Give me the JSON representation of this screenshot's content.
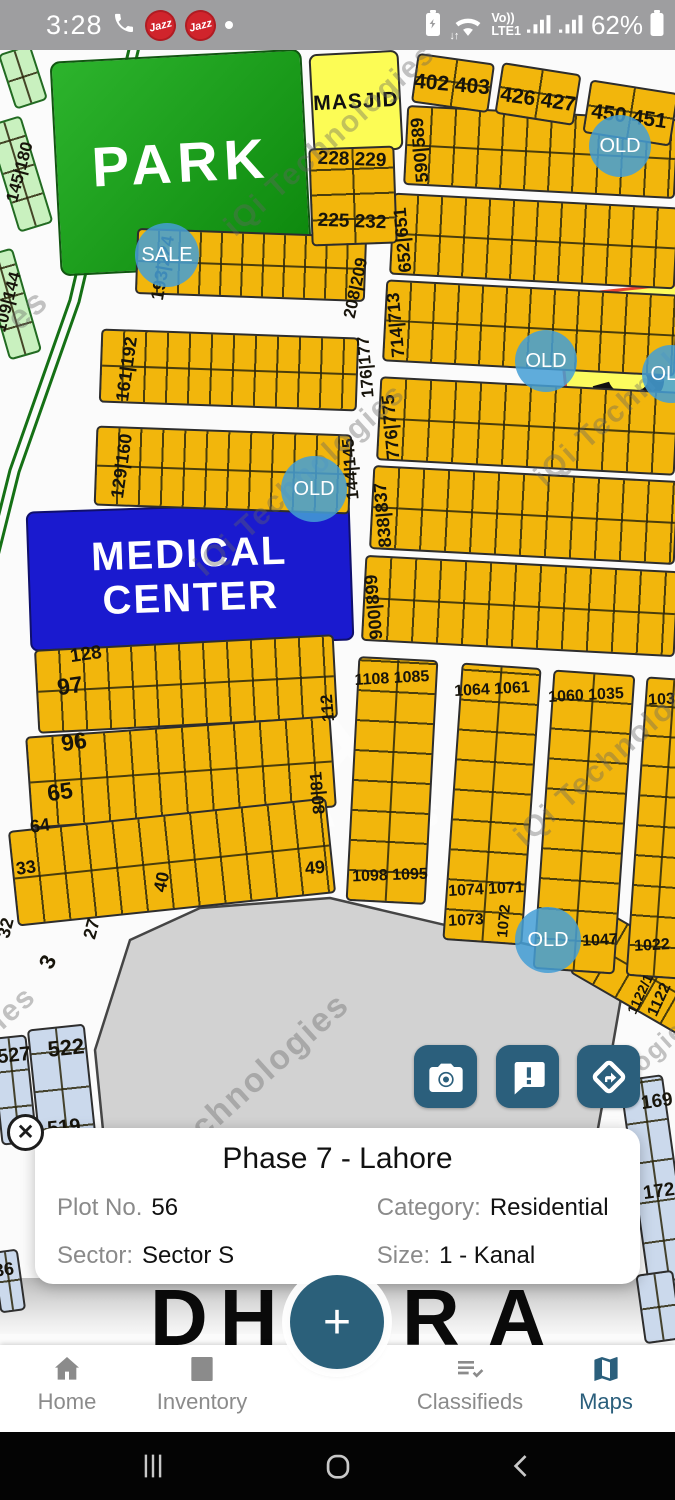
{
  "status_bar": {
    "time": "3:28",
    "carrier_badges": [
      "Jazz",
      "Jazz"
    ],
    "volte_top": "Vo))",
    "volte_bottom": "LTE1",
    "battery_percent": "62%"
  },
  "map": {
    "areas": [
      {
        "id": "park",
        "x": 55,
        "y": 55,
        "w": 252,
        "h": 215,
        "rot": -3,
        "fill": "linear-gradient(135deg,#2db42d,#0c870c)",
        "border": "2.5px solid #115511",
        "radius": 10,
        "title": "PARK",
        "ts": 56,
        "tc": "#ffffff",
        "ls": 6
      },
      {
        "id": "masjid",
        "x": 311,
        "y": 52,
        "w": 90,
        "h": 100,
        "rot": -3,
        "fill": "#fcfc55",
        "border": "2.5px solid #2d2d2d",
        "radius": 8,
        "title": "MASJID",
        "ts": 21,
        "tc": "#111111",
        "ls": 1
      },
      {
        "id": "sector-s",
        "x": 562,
        "y": 288,
        "w": 130,
        "h": 150,
        "rot": -6,
        "fill": "rgba(252,252,85,0.95)",
        "border": "3px solid #e8432f",
        "radius": 14,
        "title": "S",
        "ts": 120,
        "tc": "#111111",
        "ls": 0
      },
      {
        "id": "medical-center",
        "x": 28,
        "y": 506,
        "w": 324,
        "h": 140,
        "rot": -2,
        "fill": "#1a1acf",
        "border": "2.5px solid #10106b",
        "radius": 8,
        "title": "MEDICAL\nCENTER",
        "ts": 40,
        "tc": "#ffffff",
        "ls": 2
      }
    ],
    "rows": [
      {
        "x": 136,
        "y": 232,
        "w": 230,
        "h": 66,
        "rot": 2,
        "cell": 21
      },
      {
        "x": 100,
        "y": 333,
        "w": 258,
        "h": 74,
        "rot": 2,
        "cell": 22
      },
      {
        "x": 95,
        "y": 430,
        "w": 256,
        "h": 80,
        "rot": 2,
        "cell": 22
      },
      {
        "x": 405,
        "y": 112,
        "w": 272,
        "h": 80,
        "rot": 3,
        "cell": 24
      },
      {
        "x": 391,
        "y": 200,
        "w": 286,
        "h": 82,
        "rot": 3,
        "cell": 24
      },
      {
        "x": 384,
        "y": 287,
        "w": 293,
        "h": 82,
        "rot": 3,
        "cell": 24
      },
      {
        "x": 378,
        "y": 384,
        "w": 299,
        "h": 84,
        "rot": 3,
        "cell": 25
      },
      {
        "x": 371,
        "y": 473,
        "w": 306,
        "h": 84,
        "rot": 3,
        "cell": 25
      },
      {
        "x": 363,
        "y": 563,
        "w": 314,
        "h": 86,
        "rot": 3,
        "cell": 25
      },
      {
        "x": 36,
        "y": 642,
        "w": 300,
        "h": 84,
        "rot": -3,
        "cell": 24
      },
      {
        "x": 28,
        "y": 726,
        "w": 306,
        "h": 92,
        "rot": -4,
        "cell": 26
      },
      {
        "x": 12,
        "y": 814,
        "w": 320,
        "h": 96,
        "rot": -6,
        "cell": 26
      },
      {
        "x": 578,
        "y": 938,
        "w": 132,
        "h": 72,
        "rot": 30,
        "cell": 26
      }
    ],
    "cols": [
      {
        "x": 352,
        "y": 658,
        "w": 80,
        "h": 245,
        "rot": 3,
        "cell": 30
      },
      {
        "x": 452,
        "y": 665,
        "w": 80,
        "h": 278,
        "rot": 4,
        "cell": 30
      },
      {
        "x": 543,
        "y": 672,
        "w": 82,
        "h": 300,
        "rot": 4,
        "cell": 30
      },
      {
        "x": 636,
        "y": 678,
        "w": 56,
        "h": 300,
        "rot": 4,
        "cell": 30
      },
      {
        "x": 2,
        "y": 118,
        "w": 36,
        "h": 112,
        "rot": -17,
        "cell": 30,
        "fill": "lg"
      },
      {
        "x": -6,
        "y": 250,
        "w": 34,
        "h": 108,
        "rot": -16,
        "cell": 30,
        "fill": "lg"
      },
      {
        "x": 6,
        "y": 48,
        "w": 34,
        "h": 58,
        "rot": -18,
        "cell": 28,
        "fill": "lg"
      },
      {
        "x": -4,
        "y": 1036,
        "w": 36,
        "h": 108,
        "rot": -6,
        "cell": 36,
        "fill": "lb"
      },
      {
        "x": 38,
        "y": 1026,
        "w": 58,
        "h": 216,
        "rot": -6,
        "cell": 38,
        "fill": "lb"
      },
      {
        "x": 636,
        "y": 1076,
        "w": 44,
        "h": 246,
        "rot": -8,
        "cell": 40,
        "fill": "lb"
      },
      {
        "x": -4,
        "y": 1250,
        "w": 26,
        "h": 62,
        "rot": -8,
        "cell": 30,
        "fill": "lb"
      },
      {
        "x": 640,
        "y": 1272,
        "w": 38,
        "h": 70,
        "rot": -8,
        "cell": 34,
        "fill": "lb"
      }
    ],
    "grids": [
      {
        "x": 310,
        "y": 147,
        "w": 86,
        "h": 98,
        "rot": -2,
        "cellx": 43,
        "celly": 25
      },
      {
        "x": 414,
        "y": 58,
        "w": 78,
        "h": 50,
        "rot": 8,
        "cellx": 39,
        "celly": 25
      },
      {
        "x": 498,
        "y": 68,
        "w": 80,
        "h": 52,
        "rot": 9,
        "cellx": 40,
        "celly": 26
      },
      {
        "x": 586,
        "y": 86,
        "w": 89,
        "h": 54,
        "rot": 9,
        "cellx": 44,
        "celly": 27
      }
    ],
    "labels": [
      {
        "t": "193|224",
        "x": 163,
        "y": 268,
        "r": -80,
        "s": 18
      },
      {
        "t": "161|192",
        "x": 127,
        "y": 369,
        "r": -82,
        "s": 18
      },
      {
        "t": "176|177",
        "x": 366,
        "y": 367,
        "r": -95,
        "s": 17
      },
      {
        "t": "129|160",
        "x": 122,
        "y": 466,
        "r": -82,
        "s": 18
      },
      {
        "t": "144|145",
        "x": 351,
        "y": 469,
        "r": -95,
        "s": 17
      },
      {
        "t": "208|209",
        "x": 356,
        "y": 288,
        "r": -78,
        "s": 17
      },
      {
        "t": "590|589",
        "x": 420,
        "y": 150,
        "r": -95,
        "s": 18
      },
      {
        "t": "652|651",
        "x": 403,
        "y": 240,
        "r": -95,
        "s": 18
      },
      {
        "t": "714|713",
        "x": 396,
        "y": 325,
        "r": -95,
        "s": 18
      },
      {
        "t": "776|775",
        "x": 391,
        "y": 427,
        "r": -95,
        "s": 18
      },
      {
        "t": "838|837",
        "x": 383,
        "y": 515,
        "r": -95,
        "s": 18
      },
      {
        "t": "900|899",
        "x": 374,
        "y": 607,
        "r": -95,
        "s": 18
      },
      {
        "t": "402 403",
        "x": 452,
        "y": 85,
        "r": 5,
        "s": 21
      },
      {
        "t": "426 427",
        "x": 538,
        "y": 100,
        "r": 8,
        "s": 21
      },
      {
        "t": "450 451",
        "x": 629,
        "y": 117,
        "r": 8,
        "s": 21
      },
      {
        "t": "228 229",
        "x": 352,
        "y": 160,
        "r": 2,
        "s": 19
      },
      {
        "t": "225 232",
        "x": 352,
        "y": 222,
        "r": 2,
        "s": 19
      },
      {
        "t": "128",
        "x": 86,
        "y": 655,
        "r": -8,
        "s": 19
      },
      {
        "t": "97",
        "x": 70,
        "y": 686,
        "r": -8,
        "s": 23
      },
      {
        "t": "96",
        "x": 74,
        "y": 742,
        "r": -8,
        "s": 23
      },
      {
        "t": "65",
        "x": 60,
        "y": 792,
        "r": -8,
        "s": 23
      },
      {
        "t": "64",
        "x": 40,
        "y": 826,
        "r": -8,
        "s": 18
      },
      {
        "t": "33",
        "x": 26,
        "y": 868,
        "r": -8,
        "s": 18
      },
      {
        "t": "32",
        "x": 6,
        "y": 928,
        "r": -75,
        "s": 18
      },
      {
        "t": "27",
        "x": 92,
        "y": 929,
        "r": -75,
        "s": 18
      },
      {
        "t": "3",
        "x": 48,
        "y": 962,
        "r": -65,
        "s": 22
      },
      {
        "t": "40",
        "x": 162,
        "y": 882,
        "r": -78,
        "s": 18
      },
      {
        "t": "49",
        "x": 315,
        "y": 868,
        "r": -5,
        "s": 18
      },
      {
        "t": "112",
        "x": 328,
        "y": 708,
        "r": -95,
        "s": 17
      },
      {
        "t": "80|81",
        "x": 318,
        "y": 793,
        "r": -95,
        "s": 17
      },
      {
        "t": "1108 1085",
        "x": 392,
        "y": 679,
        "r": -3,
        "s": 16
      },
      {
        "t": "1064 1061",
        "x": 492,
        "y": 690,
        "r": -3,
        "s": 16
      },
      {
        "t": "1060 1035",
        "x": 586,
        "y": 696,
        "r": -3,
        "s": 16
      },
      {
        "t": "1034",
        "x": 666,
        "y": 700,
        "r": -3,
        "s": 16
      },
      {
        "t": "1098 1095",
        "x": 390,
        "y": 876,
        "r": -2,
        "s": 16
      },
      {
        "t": "1074 1071",
        "x": 486,
        "y": 890,
        "r": -3,
        "s": 16
      },
      {
        "t": "1073",
        "x": 466,
        "y": 921,
        "r": -3,
        "s": 16
      },
      {
        "t": "1072",
        "x": 504,
        "y": 921,
        "r": -85,
        "s": 15
      },
      {
        "t": "1047",
        "x": 600,
        "y": 941,
        "r": -3,
        "s": 16
      },
      {
        "t": "1022",
        "x": 652,
        "y": 946,
        "r": -3,
        "s": 16
      },
      {
        "t": "1122/1",
        "x": 640,
        "y": 994,
        "r": -65,
        "s": 14
      },
      {
        "t": "1122",
        "x": 660,
        "y": 1000,
        "r": -65,
        "s": 16
      },
      {
        "t": "145|180",
        "x": 20,
        "y": 172,
        "r": -75,
        "s": 17
      },
      {
        "t": "109|144",
        "x": 8,
        "y": 302,
        "r": -75,
        "s": 17
      },
      {
        "t": "527",
        "x": 14,
        "y": 1056,
        "r": -6,
        "s": 20
      },
      {
        "t": "522",
        "x": 66,
        "y": 1048,
        "r": -6,
        "s": 22
      },
      {
        "t": "519",
        "x": 64,
        "y": 1128,
        "r": -6,
        "s": 20
      },
      {
        "t": "169",
        "x": 657,
        "y": 1102,
        "r": -8,
        "s": 19
      },
      {
        "t": "172",
        "x": 659,
        "y": 1192,
        "r": -8,
        "s": 19
      },
      {
        "t": "36",
        "x": 4,
        "y": 1270,
        "r": -8,
        "s": 18
      }
    ],
    "badges": [
      {
        "t": "SALE",
        "x": 167,
        "y": 255,
        "d": 64
      },
      {
        "t": "OLD",
        "x": 620,
        "y": 146,
        "d": 62
      },
      {
        "t": "OLD",
        "x": 546,
        "y": 361,
        "d": 62
      },
      {
        "t": "OLD",
        "x": 671,
        "y": 374,
        "d": 58
      },
      {
        "t": "OLD",
        "x": 314,
        "y": 489,
        "d": 66
      },
      {
        "t": "OLD",
        "x": 548,
        "y": 940,
        "d": 66
      }
    ],
    "watermarks": [
      {
        "t": "iQi Technologies",
        "x": 330,
        "y": 140,
        "r": -42,
        "s": 30
      },
      {
        "t": "iQi Technologies",
        "x": 640,
        "y": 390,
        "r": -42,
        "s": 30
      },
      {
        "t": "iQi Technologies",
        "x": 300,
        "y": 480,
        "r": -42,
        "s": 30
      },
      {
        "t": "iQi Technologies",
        "x": 620,
        "y": 750,
        "r": -42,
        "s": 30
      },
      {
        "t": "Technologies",
        "x": 255,
        "y": 1080,
        "r": -42,
        "s": 34
      },
      {
        "t": "es",
        "x": 28,
        "y": 310,
        "r": -42,
        "s": 34
      },
      {
        "t": "ies",
        "x": 14,
        "y": 1008,
        "r": -42,
        "s": 30
      },
      {
        "t": "nologies",
        "x": 648,
        "y": 1056,
        "r": -42,
        "s": 26
      }
    ],
    "logo_text": "DHA Plus",
    "bottom_label_left": "DH",
    "bottom_label_right": "RA"
  },
  "close_label": "✕",
  "info_card": {
    "title": "Phase 7 - Lahore",
    "fields": [
      {
        "label": "Plot No.",
        "value": "56"
      },
      {
        "label": "Category:",
        "value": "Residential"
      },
      {
        "label": "Sector:",
        "value": "Sector S"
      },
      {
        "label": "Size:",
        "value": "1 - Kanal"
      }
    ]
  },
  "fab": {
    "label": "+"
  },
  "bottom_nav": {
    "items": [
      {
        "label": "Home"
      },
      {
        "label": "Inventory"
      },
      {
        "label": "Classifieds"
      },
      {
        "label": "Maps",
        "active": true
      }
    ]
  },
  "colors": {
    "accent": "#2b5f7c",
    "plot_yellow": "#f2b60c",
    "highlight_yellow": "#fcfc55",
    "park_green": "#18a018",
    "medical_blue": "#1a1acf",
    "badge_blue": "#45a0d4",
    "light_green": "#c9f1bf",
    "light_blue": "#cbd9ec",
    "open_area_gray": "#d2d2d2",
    "jazz_red": "#d0242c"
  }
}
